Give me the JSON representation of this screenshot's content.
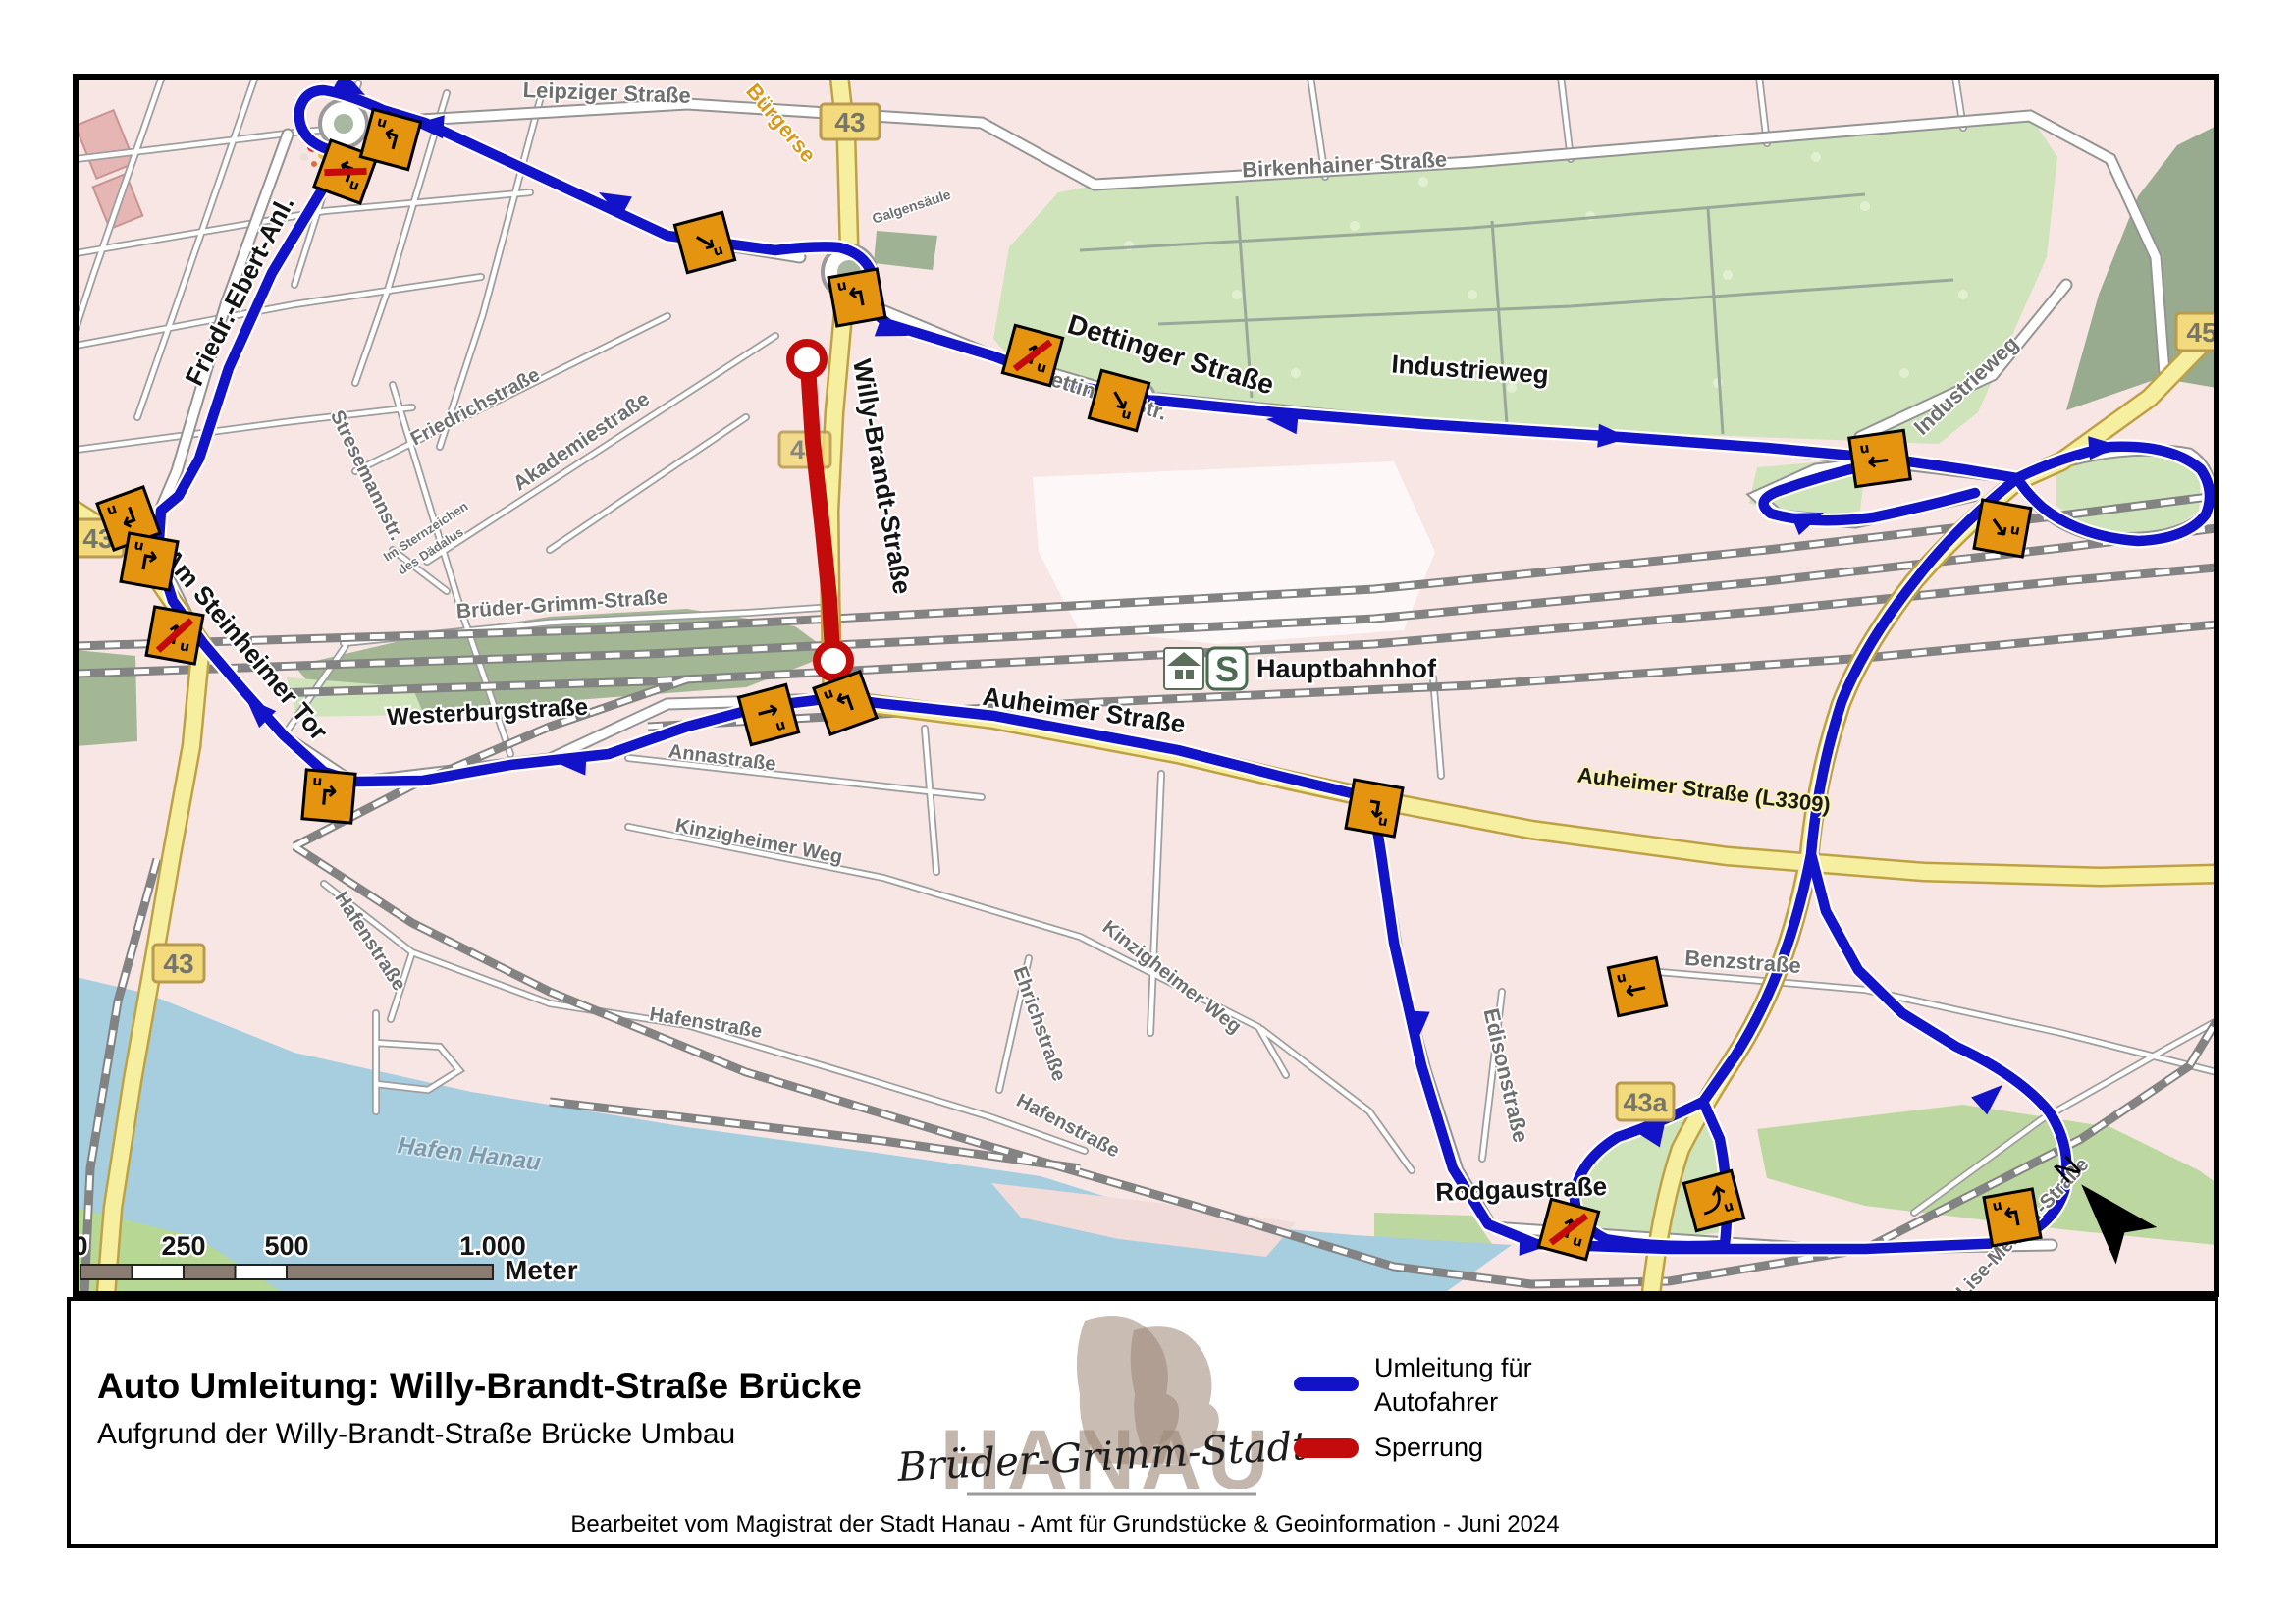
{
  "colors": {
    "detour": "#1212c8",
    "closure": "#c40b0b",
    "map_bg": "#f7e6e4",
    "water": "#a6cede",
    "park": "#cfe4ba",
    "yellow_road": "#f6ef9f",
    "sign_orange": "#e5940f"
  },
  "panel": {
    "title": "Auto Umleitung: Willy-Brandt-Straße Brücke",
    "subtitle": "Aufgrund der Willy-Brandt-Straße Brücke Umbau",
    "footer": "Bearbeitet vom Magistrat der Stadt Hanau - Amt für Grundstücke & Geoinformation - Juni 2024",
    "legend": [
      {
        "line1": "Umleitung für",
        "line2": "Autofahrer",
        "color": "#1212c8"
      },
      {
        "line1": "Sperrung",
        "line2": "",
        "color": "#c40b0b"
      }
    ],
    "logo": {
      "name": "HANAU",
      "tagline": "Brüder-Grimm-Stadt"
    }
  },
  "map": {
    "north": "N",
    "sign_u": "u",
    "scalebar": {
      "t0": "0",
      "t1": "250",
      "t2": "500",
      "t3": "1.000",
      "unit": "Meter"
    },
    "hbf": {
      "label": "Hauptbahn­hof",
      "s": "S"
    },
    "shields": [
      {
        "label": "43"
      },
      {
        "label": "43"
      },
      {
        "label": "43"
      },
      {
        "label": "43"
      },
      {
        "label": "43a"
      },
      {
        "label": "45"
      }
    ],
    "street_labels": [
      {
        "text": "Leipziger Straße"
      },
      {
        "text": "Friedr.-Ebert-Anl."
      },
      {
        "text": "Am Steinheimer Tor"
      },
      {
        "text": "Stresemannstr."
      },
      {
        "text": "Friedrichstraße"
      },
      {
        "text": "Akademiestraße"
      },
      {
        "text": "Im Sternzeichen"
      },
      {
        "text": "des Dädalus"
      },
      {
        "text": "Brüder-Grimm-Straße"
      },
      {
        "text": "Westerburgstraße"
      },
      {
        "text": "Annastraße"
      },
      {
        "text": "Kinzigheimer Weg"
      },
      {
        "text": "Kinzigheimer Weg"
      },
      {
        "text": "Ehrichstraße"
      },
      {
        "text": "Hafenstraße"
      },
      {
        "text": "Hafenstraße"
      },
      {
        "text": "Hafenstraße"
      },
      {
        "text": "Hafen Hanau"
      },
      {
        "text": "Dettinger Straße"
      },
      {
        "text": "Dettinger Str."
      },
      {
        "text": "Industrieweg"
      },
      {
        "text": "Industrieweg"
      },
      {
        "text": "Birkenhainer Straße"
      },
      {
        "text": "Hauptbahnhof"
      },
      {
        "text": "Auheimer Straße"
      },
      {
        "text": "Auheimer Straße (L3309)"
      },
      {
        "text": "Benzstraße"
      },
      {
        "text": "Edisonstraße"
      },
      {
        "text": "Rodgaustraße"
      },
      {
        "text": "Lise-Meitner-Straße"
      },
      {
        "text": "Willy-Brandt-Straße"
      },
      {
        "text": "Bürgerse"
      },
      {
        "text": "Galgensäule"
      }
    ],
    "signs": [
      {
        "arrow": "↰"
      },
      {
        "arrow": "↰"
      },
      {
        "arrow": "↘"
      },
      {
        "arrow": "↰"
      },
      {
        "arrow": "↑"
      },
      {
        "arrow": "↘"
      },
      {
        "arrow": "←"
      },
      {
        "arrow": "↘"
      },
      {
        "arrow": "↴"
      },
      {
        "arrow": "→"
      },
      {
        "arrow": "↰"
      },
      {
        "arrow": "↱"
      },
      {
        "arrow": "↲"
      },
      {
        "arrow": "↱"
      },
      {
        "arrow": "↑"
      },
      {
        "arrow": "↑"
      },
      {
        "arrow": "⤴"
      },
      {
        "arrow": "↰"
      },
      {
        "arrow": "←"
      }
    ]
  }
}
